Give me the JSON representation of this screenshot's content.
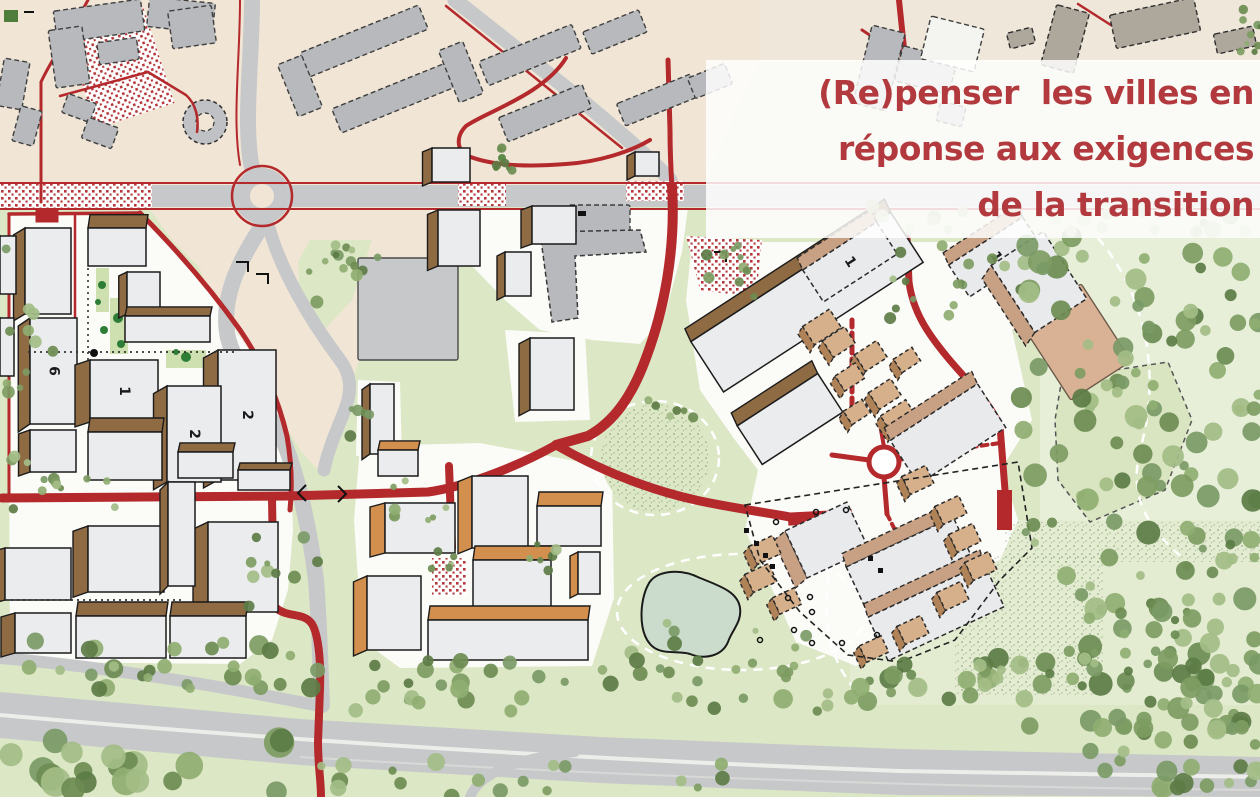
{
  "title": {
    "line1": "(Re)penser  les villes en",
    "line2": "réponse aux exigences",
    "line3": "de la transition"
  },
  "map": {
    "colors": {
      "title_red": "#b23a3e",
      "panel_white": "rgba(255,255,255,0.84)",
      "path_red": "#b3292c",
      "road_gray": "#c6c8ca",
      "urban_beige": "#f1e5d5",
      "urban_beige_light": "#efe8da",
      "lawn_green": "#dce7c5",
      "lawn_light": "#e7efd9",
      "campus_white": "#fbfbf8",
      "water_green": "#cbdccd",
      "tree_dark": "#5c7c45",
      "tree_mid": "#7d9c62",
      "tree_light": "#a3bd85",
      "wall_brown": "#8f6b44",
      "wall_orange": "#d28f4e",
      "wall_tan": "#c8a184",
      "roof_light": "#ebecee",
      "existing_gray": "#b7b9bc",
      "existing_taupe": "#aea79b",
      "salmon": "#d9b296"
    },
    "building_labels": [
      {
        "text": "2"
      },
      {
        "text": "2"
      },
      {
        "text": "1"
      },
      {
        "text": "1"
      },
      {
        "text": "6"
      },
      {
        "text": "1"
      }
    ]
  }
}
